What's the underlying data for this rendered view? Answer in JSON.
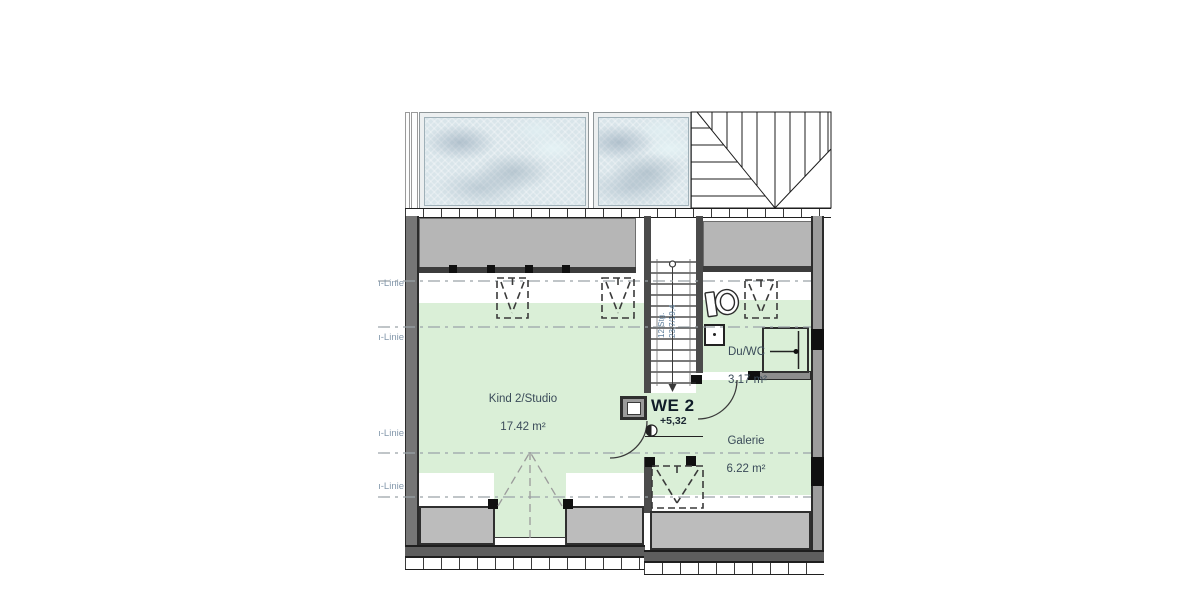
{
  "plan": {
    "height_line_label": "ı-Linie",
    "rooms": {
      "kind": {
        "name": "Kind 2/Studio",
        "area": "17.42 m²"
      },
      "duwc": {
        "name": "Du/WC",
        "area": "3.17 m²"
      },
      "galerie": {
        "name": "Galerie",
        "area": "6.22 m²"
      }
    },
    "unit": {
      "label": "WE 2"
    },
    "level": {
      "value": "+5,32"
    },
    "stair": {
      "steps": "12 Stg.",
      "dims": "23,7/19,4"
    },
    "colors": {
      "floor_green": "#daefd7",
      "knee_band": "#b6b6b6",
      "wall_dark": "#4b4b4b",
      "wall_outline": "#2b2b2b",
      "room_text": "#3a4b59",
      "height_line_text": "#8498ab",
      "stair_text": "#5c7e9b",
      "glass_blue": "#d9e5ea"
    }
  }
}
